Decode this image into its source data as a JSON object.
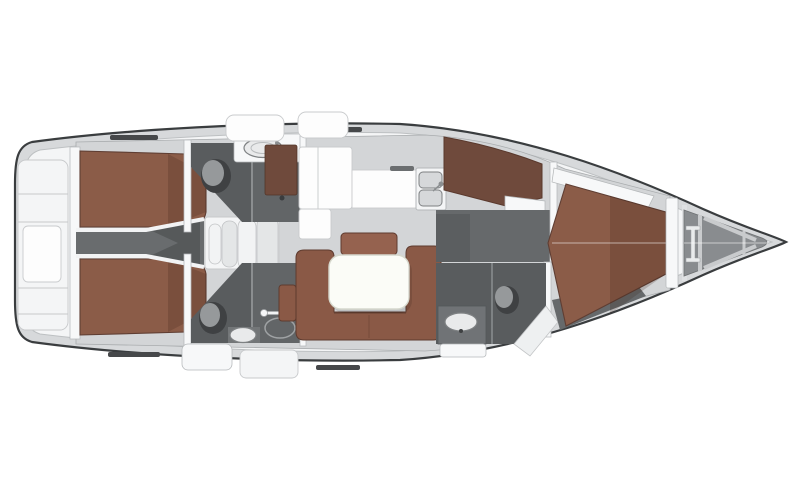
{
  "meta": {
    "type": "boat-floorplan",
    "description": "Top-view interior layout plan of a sailing yacht; stern with swim platform at left, pointed bow at right. No text labels are rendered in the image.",
    "orientation": {
      "stern": "left",
      "bow": "right"
    }
  },
  "palette": {
    "background": "#ffffff",
    "hull_outline": "#3a3d3f",
    "hull_rim": "#d7d9db",
    "deck": "#f4f5f6",
    "wall_white": "#f7f8f9",
    "seam": "#c7c9cb",
    "floor_light": "#d3d5d7",
    "floor_dark": "#595c5e",
    "corridor": "#696c6e",
    "passage": "#66696b",
    "anchor_locker": "#898c8f",
    "berth": "#8b5c48",
    "berth_edge": "#5f3e33",
    "sofa": "#8a5946",
    "sofa_back": "#95624f",
    "wardrobe": "#6f4a3c",
    "table": "#fbfcf7"
  },
  "regions": [
    "swim-platform",
    "transom-lockers",
    "aft-cabin-port-berth",
    "aft-cabin-starboard-berth",
    "aft-corridor",
    "companionway-steps",
    "head-port",
    "head-starboard",
    "shower-starboard",
    "galley-counter",
    "galley-sink",
    "wardrobe",
    "salon-sofa",
    "salon-table",
    "salon-bench",
    "nav-seat",
    "forward-passage",
    "forward-head",
    "forward-cabin-berth",
    "forward-shelf",
    "collision-bulkhead",
    "anchor-locker",
    "bow-tip",
    "deck-hatches",
    "cockpit-lockers"
  ]
}
